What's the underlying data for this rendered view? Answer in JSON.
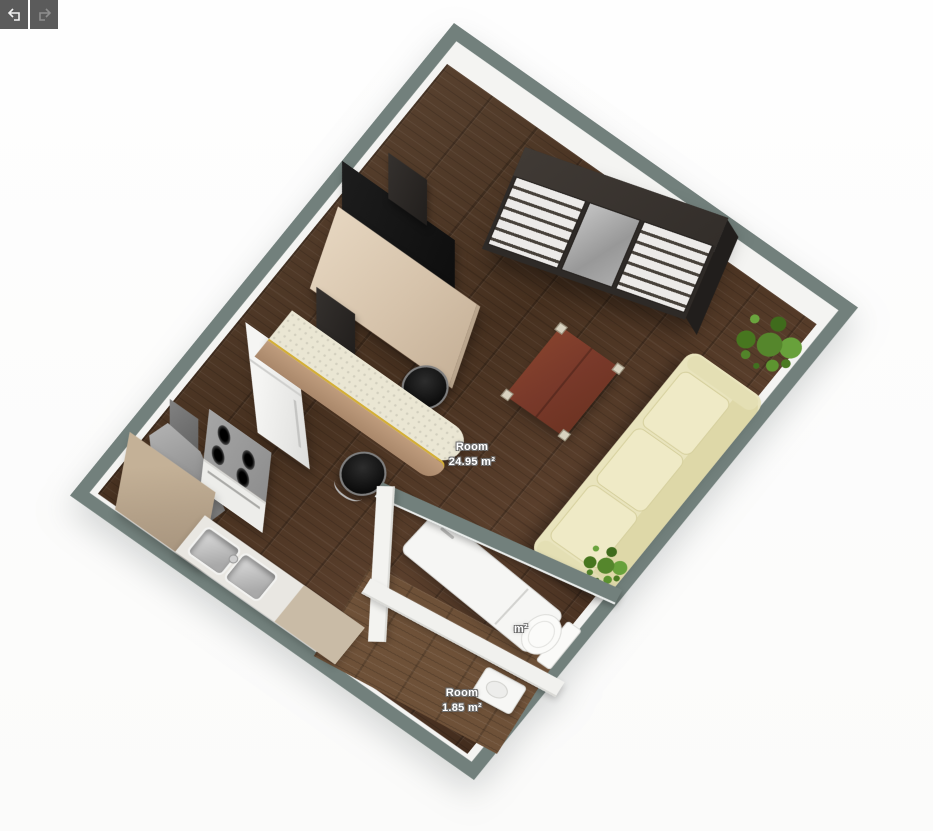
{
  "toolbar": {
    "undo_label": "Undo",
    "redo_label": "Redo"
  },
  "rooms": {
    "main": {
      "name": "Room",
      "area": "24.95 m²"
    },
    "hall": {
      "name": "Room",
      "area": "1.85 m²"
    },
    "bath": {
      "area_fragment": "m²"
    }
  },
  "icons": [
    "undo-arrow-icon",
    "redo-arrow-icon"
  ],
  "colors": {
    "wall_top": "#72807c",
    "wall_face": "#f4f4f2",
    "floor_main": "#4e3628",
    "floor_hall": "#6e5138",
    "sofa": "#e9e4bd",
    "bar_counter_top": "#eae6d3",
    "bar_counter_gold_trim": "#d4af37",
    "coffee_table": "#7c3e2b",
    "plant": "#55862c",
    "toolbar_button_bg": "#5b5b5b"
  },
  "furniture": [
    "wardrobe",
    "tv",
    "speaker",
    "media-console",
    "fridge",
    "range-hood",
    "stove",
    "kitchen-corner-cabinet",
    "sink-counter",
    "bar-counter",
    "bar-stool",
    "coffee-table",
    "sofa",
    "plant",
    "shower",
    "toilet",
    "washbasin"
  ]
}
